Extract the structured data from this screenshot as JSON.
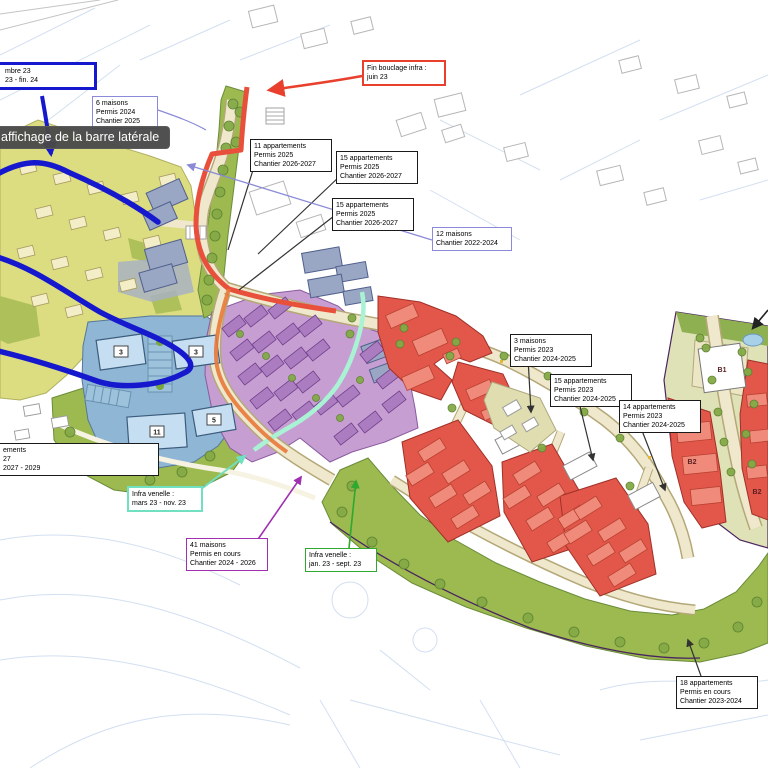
{
  "tooltip": {
    "text": "affichage de la barre latérale"
  },
  "labels": {
    "infra_top": {
      "l1": "mbre 23",
      "l2": "23 - fin. 24"
    },
    "maisons6": {
      "l1": "6 maisons",
      "l2": "Permis 2024",
      "l3": "Chantier 2025"
    },
    "fin_bouclage": {
      "l1": "Fin bouclage infra :",
      "l2": "juin 23"
    },
    "apt11": {
      "l1": "11 appartements",
      "l2": "Permis 2025",
      "l3": "Chantier 2026-2027"
    },
    "apt15a": {
      "l1": "15 appartements",
      "l2": "Permis 2025",
      "l3": "Chantier 2026-2027"
    },
    "apt15b": {
      "l1": "15 appartements",
      "l2": "Permis 2025",
      "l3": "Chantier 2026-2027"
    },
    "maisons12": {
      "l1": "12 maisons",
      "l2": "Chantier 2022-2024"
    },
    "maisons3": {
      "l1": "3 maisons",
      "l2": "Permis 2023",
      "l3": "Chantier 2024-2025"
    },
    "apt15c": {
      "l1": "15 appartements",
      "l2": "Permis 2023",
      "l3": "Chantier 2024-2025"
    },
    "apt14": {
      "l1": "14 appartements",
      "l2": "Permis 2023",
      "l3": "Chantier 2024-2025"
    },
    "partial_left": {
      "l1": "ements",
      "l2": "27",
      "l3": "2027 - 2029"
    },
    "venelle_mars": {
      "l1": "Infra venelle :",
      "l2": "mars 23 - nov. 23"
    },
    "maisons41": {
      "l1": "41 maisons",
      "l2": "Permis en cours",
      "l3": "Chantier 2024 - 2026"
    },
    "venelle_jan": {
      "l1": "Infra venelle :",
      "l2": "jan. 23 - sept. 23"
    },
    "apt18": {
      "l1": "18 appartements",
      "l2": "Permis en cours",
      "l3": "Chantier 2023-2024"
    }
  },
  "map": {
    "unit_counts": {
      "c1": "3",
      "c2": "3",
      "c3": "11",
      "c4": "5"
    },
    "blocks": {
      "b1": "B1",
      "b2a": "B2",
      "b2b": "B2"
    }
  },
  "colors": {
    "route_infra_red": "#e8402c",
    "boucle_blue": "#1518cc",
    "venelle_mars_teal": "#70e0c0",
    "venelle_jan_green": "#2ea82e",
    "maisons41_purple": "#a030b0",
    "label_lavender": "#8a8ad8"
  }
}
